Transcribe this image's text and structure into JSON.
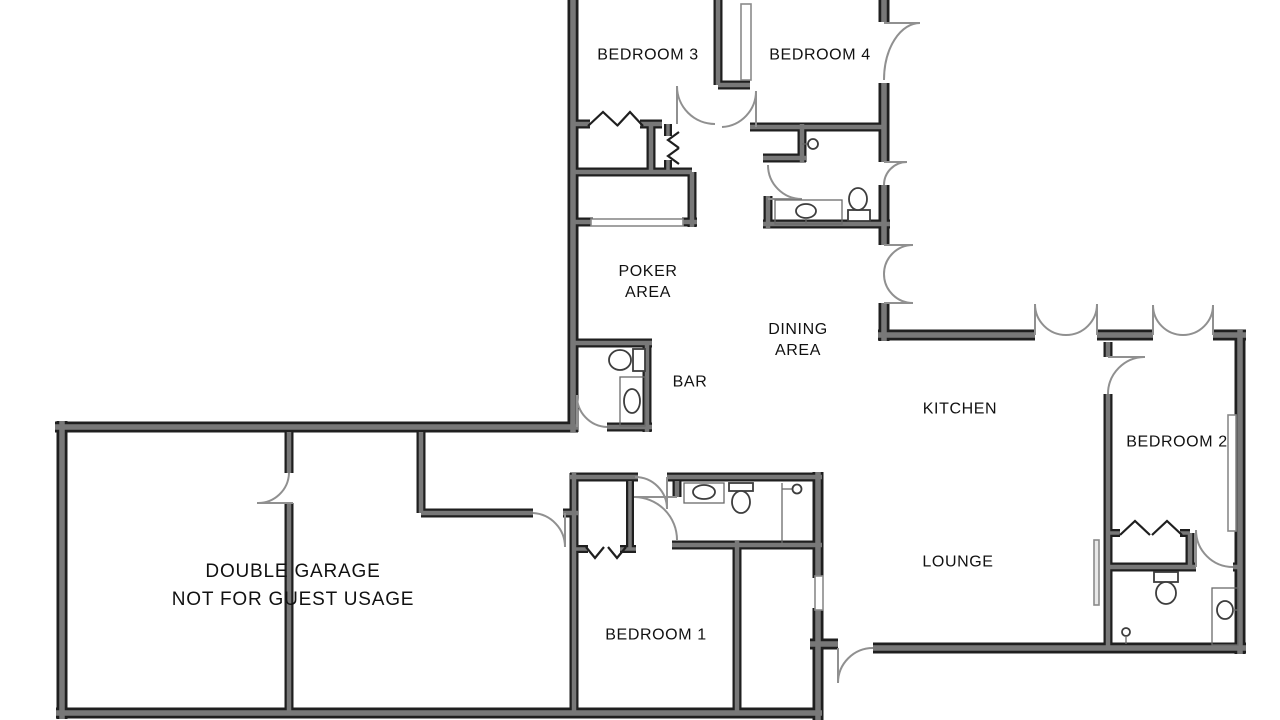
{
  "canvas": {
    "width": 1280,
    "height": 720,
    "background": "#ffffff"
  },
  "palette": {
    "background": "#ffffff",
    "wall_edge": "#1f1f1f",
    "wall_fill": "#787878",
    "door_arc": "#909090",
    "window_fill": "#ffffff",
    "thin_line": "#8a8a8a",
    "fixture_stroke": "#3d3d3d",
    "label_text": "#111111"
  },
  "rooms": [
    {
      "id": "bedroom-3",
      "label": "BEDROOM 3"
    },
    {
      "id": "bedroom-4",
      "label": "BEDROOM 4"
    },
    {
      "id": "poker-area",
      "label": "POKER\nAREA"
    },
    {
      "id": "dining-area",
      "label": "DINING\nAREA"
    },
    {
      "id": "bar",
      "label": "BAR"
    },
    {
      "id": "kitchen",
      "label": "KITCHEN"
    },
    {
      "id": "bedroom-2",
      "label": "BEDROOM 2"
    },
    {
      "id": "lounge",
      "label": "LOUNGE"
    },
    {
      "id": "bedroom-1",
      "label": "BEDROOM 1"
    },
    {
      "id": "double-garage",
      "label": "DOUBLE GARAGE\nNOT FOR GUEST USAGE"
    }
  ],
  "fixtures": [
    {
      "type": "toilet",
      "room": "bar bathroom"
    },
    {
      "type": "sink",
      "room": "bar bathroom"
    },
    {
      "type": "toilet",
      "room": "hall bathroom"
    },
    {
      "type": "sink",
      "room": "hall bathroom"
    },
    {
      "type": "shower-door-handle",
      "room": "hall bathroom"
    },
    {
      "type": "toilet",
      "room": "bedroom 1 ensuite"
    },
    {
      "type": "sink",
      "room": "bedroom 1 ensuite"
    },
    {
      "type": "shower-door-handle",
      "room": "bedroom 1 ensuite"
    },
    {
      "type": "toilet",
      "room": "bedroom 2 ensuite"
    },
    {
      "type": "sink",
      "room": "bedroom 2 ensuite"
    },
    {
      "type": "door-handle",
      "room": "bedroom 2 ensuite"
    }
  ]
}
